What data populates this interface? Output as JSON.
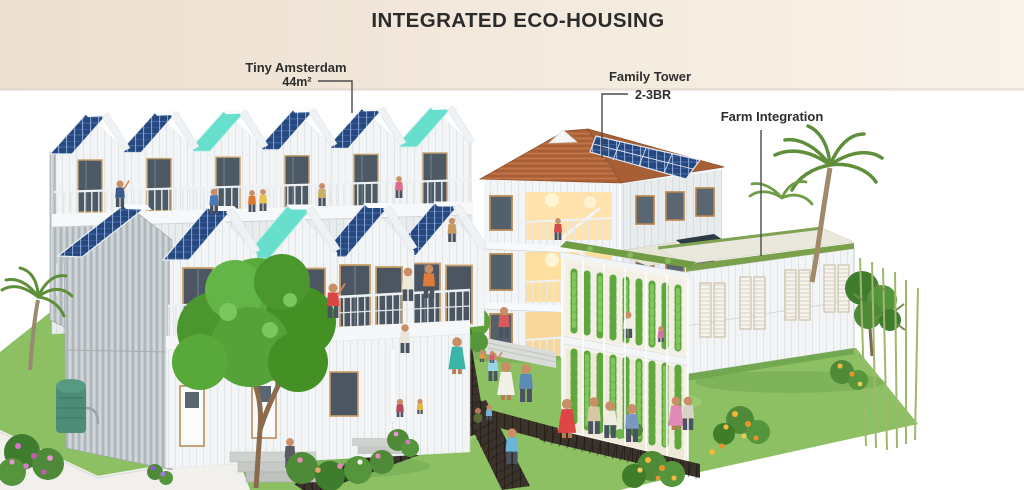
{
  "title": "INTEGRATED ECO-HOUSING",
  "annotations": {
    "tiny_amsterdam": {
      "label": "Tiny Amsterdam",
      "sublabel": "44m²"
    },
    "family_tower": {
      "label": "Family Tower",
      "sublabel": "2-3BR"
    },
    "farm_integration": {
      "label": "Farm Integration"
    }
  },
  "colors": {
    "header_gradient_left": "#ecdfd0",
    "header_gradient_right": "#faf3e9",
    "title_text": "#2b2b2b",
    "annotation_text": "#2e2e2e",
    "leader_line": "#4a4a4a",
    "solar_panel_blue": "#26487e",
    "teal_roof": "#68dfcd",
    "terracotta_roof": "#b5683d",
    "white_siding": "#f2f4f5",
    "grass_green": "#8cc063",
    "boardwalk_brown": "#3a322b",
    "foliage_green": "#55a238"
  }
}
